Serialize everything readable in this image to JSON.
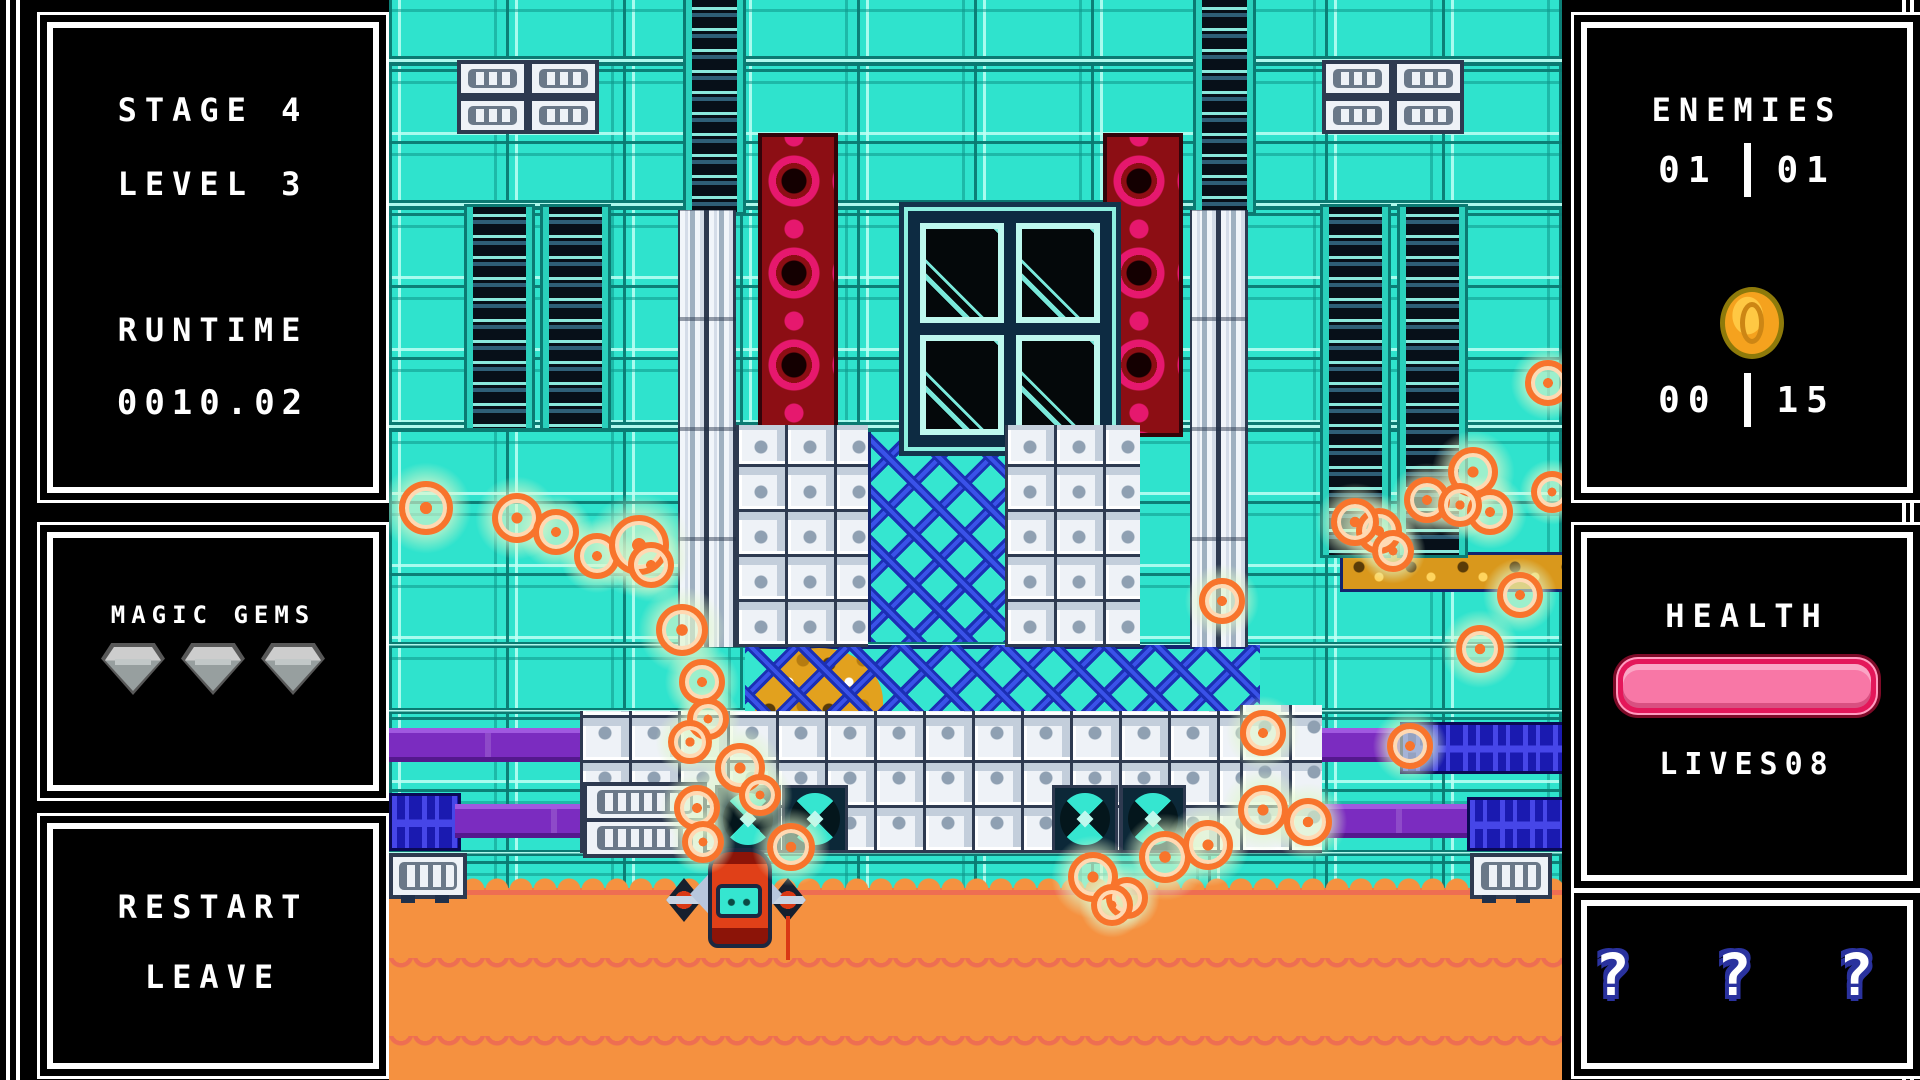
{
  "left_hud": {
    "stage_label": "STAGE",
    "stage_value": "4",
    "level_label": "LEVEL",
    "level_value": "3",
    "runtime_label": "RUNTIME",
    "runtime_value": "0010.02",
    "gems_label": "MAGIC GEMS",
    "gems_count": 3,
    "restart_label": "RESTART",
    "leave_label": "LEAVE"
  },
  "right_hud": {
    "enemies_label": "ENEMIES",
    "enemies_current": "01",
    "enemies_total": "01",
    "coins_collected": "00",
    "coins_total": "15",
    "health_label": "HEALTH",
    "health_percent": 100,
    "lives_label": "LIVES",
    "lives_value": "08",
    "mystery_text": "? ? ?"
  },
  "colors": {
    "teal": "#35e6d0",
    "ring_orange": "#f8742c",
    "water": "#f59140",
    "health_pink": "#f877a6",
    "purple_pipe": "#7b2cc0",
    "blue_pipe": "#1a1ab0",
    "red_column": "#8c0e14",
    "lattice_blue": "#1b2fb4"
  },
  "playfield": {
    "player": {
      "x": 277,
      "y": 848
    },
    "rings": [
      [
        37,
        508,
        42
      ],
      [
        128,
        518,
        38
      ],
      [
        167,
        532,
        34
      ],
      [
        208,
        556,
        34
      ],
      [
        250,
        545,
        48
      ],
      [
        262,
        565,
        34
      ],
      [
        293,
        630,
        40
      ],
      [
        313,
        682,
        34
      ],
      [
        319,
        719,
        30
      ],
      [
        301,
        742,
        32
      ],
      [
        351,
        768,
        38
      ],
      [
        371,
        795,
        30
      ],
      [
        308,
        808,
        34
      ],
      [
        314,
        842,
        30
      ],
      [
        402,
        847,
        36
      ],
      [
        704,
        877,
        38
      ],
      [
        738,
        898,
        30
      ],
      [
        776,
        857,
        40
      ],
      [
        819,
        845,
        38
      ],
      [
        874,
        810,
        38
      ],
      [
        919,
        822,
        36
      ],
      [
        833,
        601,
        34
      ],
      [
        874,
        733,
        34
      ],
      [
        1021,
        746,
        34
      ],
      [
        1091,
        649,
        36
      ],
      [
        1131,
        595,
        34
      ],
      [
        1084,
        472,
        38
      ],
      [
        1101,
        512,
        34
      ],
      [
        990,
        531,
        34
      ],
      [
        1004,
        551,
        30
      ],
      [
        1159,
        383,
        34
      ],
      [
        1163,
        492,
        30
      ],
      [
        966,
        522,
        36
      ],
      [
        1038,
        500,
        34
      ],
      [
        1071,
        505,
        32
      ],
      [
        723,
        905,
        30
      ]
    ]
  }
}
